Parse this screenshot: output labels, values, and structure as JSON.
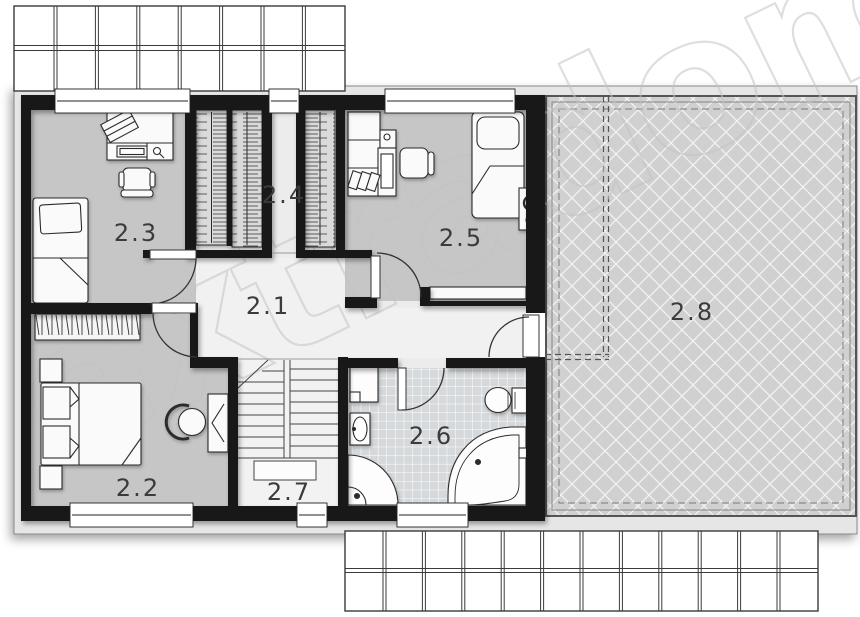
{
  "watermark": "extradom",
  "rooms": [
    {
      "label": "2.1"
    },
    {
      "label": "2.2"
    },
    {
      "label": "2.3"
    },
    {
      "label": "2.4"
    },
    {
      "label": "2.5"
    },
    {
      "label": "2.6"
    },
    {
      "label": "2.7"
    },
    {
      "label": "2.8"
    }
  ],
  "colors": {
    "wall": "#181818",
    "bedroom_floor": "#c6c6c6",
    "hall_floor": "#f1f1f1",
    "base_floor": "#ececec",
    "bath_floor": "#d6d9db",
    "terrace": "#d0d0d0",
    "wardrobe_fill": "#dadada",
    "eave": "#e6e6e6",
    "line": "#2b2b2b"
  }
}
